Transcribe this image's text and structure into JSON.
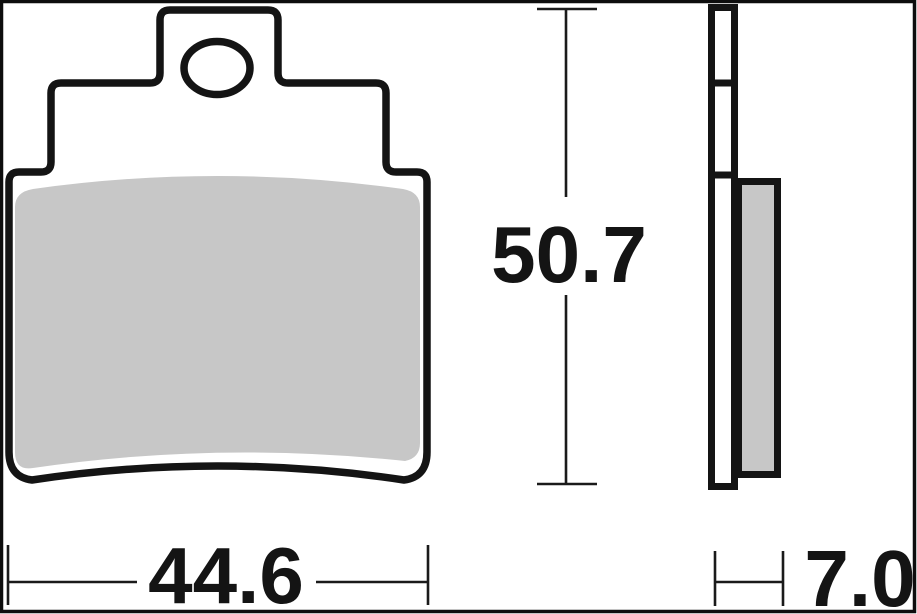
{
  "dimensions": {
    "height_mm": "50.7",
    "width_mm": "44.6",
    "thickness_mm": "7.0"
  },
  "colors": {
    "outline": "#141414",
    "friction_material": "#c7c7c7",
    "background": "#ffffff",
    "frame_border": "#0d0d0d"
  }
}
